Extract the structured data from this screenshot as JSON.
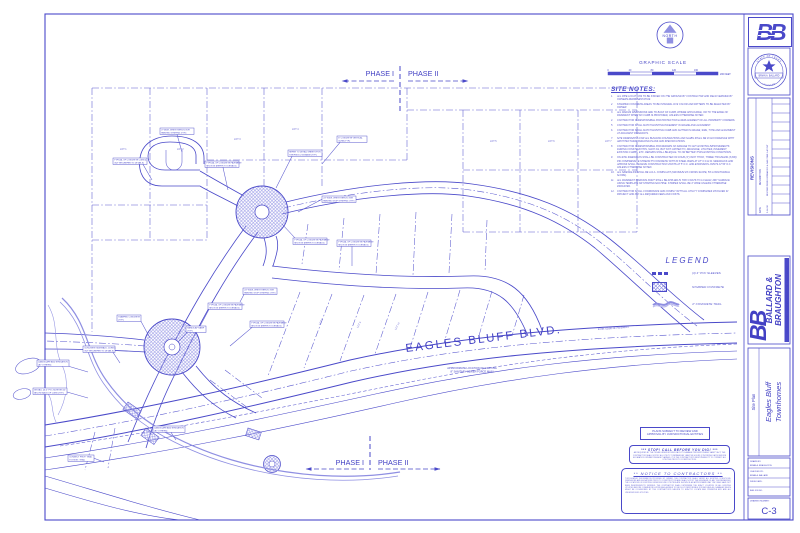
{
  "colors": {
    "line_blue": "#4a49c9",
    "light_blue": "#8f8fe2"
  },
  "north_arrow": {
    "label": "NORTH"
  },
  "graphic_scale": {
    "title": "GRAPHIC SCALE",
    "ticks": [
      "0",
      "40",
      "80",
      "120",
      "160"
    ],
    "end_label": "200 FEET"
  },
  "phases": {
    "top": {
      "left": "PHASE I",
      "right": "PHASE II"
    },
    "bottom": {
      "left": "PHASE I",
      "right": "PHASE II"
    }
  },
  "site_notes": {
    "title": "SITE NOTES:",
    "items": [
      "ALL PIPE LOCATIONS TO BE STAKED ON THE GROUND BY CONTRACTOR AND FIELD VERIFIED BY OWNERS REPRESENTATIVE.",
      "STAMPED CONCRETE AREAS TO BE INTEGRAL DYE COLOR AND PATTERN TO BE SELECTED BY OWNER.",
      "ALL RADIUS DIMENSIONS ARE TO BACK OF CURB, WHERE APPLICABLE, OR TO THE EDGE OF PAVEMENT WHEN NO CURB IS PROPOSED, UNLESS OTHERWISE NOTED.",
      "CONTRACTOR IS RESPONSIBLE FOR PROTECTION & REPLACEMENT OF ALL PROPERTY CORNERS.",
      "CONTRACTOR SHALL MATCH EXISTING PAVEMENT IN GRADE AND ALIGNMENT.",
      "CONTRACTOR SHALL MATCH EXISTING CURB AND GUTTER IN GRADE, SIZE, TYPE AND ALIGNMENT AT ADJACENT ROADWAYS.",
      "SITE DIMENSIONS FOR ALL BUILDING FOUNDATIONS AND SLABS SHALL BE IN ACCORDANCE WITH ARCHITECTURAL BUILDING PLANS AND SPECIFICATIONS.",
      "CONTRACTOR IS RESPONSIBLE FOR REPAIRS OF DAMAGE TO ANY EXISTING IMPROVEMENTS DURING CONSTRUCTION, SUCH AS, BUT NOT LIMITED TO, DRAINAGE, UTILITIES, PAVEMENT, EXISTING CURBS, ETC. REPAIRS SHALL BE EQUAL TO OR BETTER THAN EXISTING CONDITIONS.",
      "ON-SITE SIDEWALKS SHALL BE CONSTRUCTED OF FOUR (4\") INCH THICK, THREE THOUSAND (3,000) PSI COMPRESSIVE STRENGTH CONCRETE WITH #3 STEEL BARS AT 18\" O.C.E.W. SIDEWALKS AND APRONS SHALL RECEIVE CONSTRUCTION JOINTS AT 5' O.C. AND EXPANSION JOINTS AT 50' O.C. UNLESS OTHERWISE NOTED.",
      "ALL SIDEWALKS SHALL BE A.D.A. COMPLIANT (MAXIMUM 2% CROSS SLOPE, 5% LONGITUDINAL SLOPE).",
      "ALL PAVEMENT MARKING PAINT SHALL BE APPLIED IN TWO COATS TO A CLEAN, DRY SURFACE USING TEMPLATE OR STRIPING MACHINE. STRIPES SHALL BE 4\" WIDE UNLESS OTHERWISE INDICATED.",
      "CONTRACTOR SHALL COORDINATE AND COMPLY WITH ALL UTILITY COMPANIES INVOLVED IN PROJECT AND PAY ALL REQUIRED FEES AND COSTS."
    ]
  },
  "legend": {
    "title": "LEGEND",
    "items": [
      {
        "label": "(3) 4\" PVC SLEEVES"
      },
      {
        "label": "STAMPED CONCRETE"
      },
      {
        "label": "4\" CONCRETE TRAIL"
      }
    ]
  },
  "plan": {
    "road_label": "EAGLES BLUFF BLVD.",
    "force_main_note_1": "APPROXIMATE LOCATION OF EXISTING",
    "force_main_note_2": "8\" SANITARY SEWER FORCE MAIN",
    "exist_label": "EXIST. EDGE OF PAVEMENT",
    "lot_labels": [
      "LOT 1",
      "LOT 2",
      "LOT 3",
      "LOT 4",
      "LOT 5",
      "LOT 6",
      "LOT 7",
      "LOT 8",
      "LOT 9",
      "LOT 10"
    ],
    "callouts": [
      {
        "l1": "4\" WIDE, WHITE REFLECTIVE",
        "l2": "PAINTED STRIPING (TYP.)"
      },
      {
        "l1": "TYPICAL OF CONCRETE CURB &",
        "l2": "GUTTER (REFER TO DETAILS)"
      },
      {
        "l1": "TYPICAL OF CONCRETE PAVEMENT",
        "l2": "SECTION (REFER TO DETAILS)"
      },
      {
        "l1": "REFER TO DETAIL SHEETS FOR",
        "l2": "STRIPING & SIGNAGE (TYP.)"
      },
      {
        "l1": "6\" CONCRETE VERTICAL",
        "l2": "CURB (TYP.)"
      },
      {
        "l1": "24\" WIDE, WHITE REFLECTIVE",
        "l2": "PAINTED STOP STRIPING (TYP.)"
      },
      {
        "l1": "TYPICAL OF CONCRETE PAVEMENT",
        "l2": "SECTION (REFER TO DETAILS)"
      },
      {
        "l1": "TYPICAL OF CONCRETE PAVEMENT",
        "l2": "SECTION (REFER TO DETAILS)"
      },
      {
        "l1": "24\" WIDE, WHITE REFLECTIVE",
        "l2": "PAINTED STOP STRIPING (TYP.)"
      },
      {
        "l1": "TYPICAL OF CONCRETE PAVEMENT",
        "l2": "SECTION (REFER TO DETAILS)"
      },
      {
        "l1": "STAMPED CONCRETE",
        "l2": "(TYP.)"
      },
      {
        "l1": "TYPICAL OF CONCRETE PAVEMENT",
        "l2": "SECTION (REFER TO DETAILS)"
      },
      {
        "l1": "HANDICAP RAMP",
        "l2": "(TYP.)"
      },
      {
        "l1": "LANDSCAPE AND IRRIGATION",
        "l2": "(BY OTHERS)"
      },
      {
        "l1": "INSTALL (3) 4\" PVC SLEEVES 24\"",
        "l2": "BELOW BACK OF CURB (TYP.)"
      },
      {
        "l1": "CONCRETE SIDEWALK, CURB &",
        "l2": "GUTTER (REFER TO DETAILS)"
      },
      {
        "l1": "LANDSCAPE AND IRRIGATION",
        "l2": "(BY OTHERS)"
      },
      {
        "l1": "CONNECT PROP. TRAIL",
        "l2": "TO EXIST. TRAIL"
      }
    ]
  },
  "approval_box": {
    "line1": "PLANS SUBJECT TO REVIEW AND",
    "line2": "APPROVAL BY JURISDICTIONAL ENTITIES"
  },
  "call_box": {
    "title": "***   STOP!  CALL BEFORE YOU DIG!   ***",
    "body": "AS REQUIRED BY THE TEXAS UNDERGROUND FACILITY DAMAGE PREVENTION AND SAFETY ACT, THE CONTRACTOR SHALL NOTIFY ALL UTILITY COMPANIES AT LEAST 48 HOURS (2 WORKING DAYS) BEFORE EXCAVATION OPERATIONS ARE PLANNED. IT IS THE CONTRACTOR'S RESPONSIBILITY TO CONTACT ALL UTILITIES PRIOR TO CONSTRUCTION."
  },
  "notice_box": {
    "title": "**   NOTICE TO CONTRACTORS   **",
    "body": "TOPOGRAPHIC INFORMATION PROVIDED BY OWNER. THE CONTRACTOR SHALL VERIFY ALL EXISTING CONDITIONS, DIMENSIONS AND ELEVATIONS PRIOR TO CONSTRUCTION AND SHALL NOTIFY THE ENGINEER OF ANY DISCREPANCIES. THE LOCATIONS OF EXISTING UNDERGROUND UTILITIES ARE SHOWN IN AN APPROXIMATE WAY ONLY AND HAVE NOT BEEN INDEPENDENTLY VERIFIED. THE CONTRACTOR SHALL DETERMINE THE EXACT LOCATION OF ALL EXISTING UTILITIES BEFORE COMMENCING WORK AND AGREES TO BE FULLY RESPONSIBLE FOR ANY AND ALL DAMAGES WHICH MIGHT BE OCCASIONED BY THE CONTRACTOR'S FAILURE TO EXACTLY LOCATE AND PRESERVE ANY AND ALL UNDERGROUND UTILITIES."
  },
  "title_block": {
    "bb_logo": "BB",
    "seal": {
      "top": "STATE OF TEXAS",
      "name": "BRIAN A. BALLARD",
      "bottom": "LICENSED"
    },
    "revisions": {
      "title": "REVISIONS",
      "col_date": "DATE",
      "col_desc": "DESCRIPTION",
      "rows": [
        {
          "date": "5-14-08",
          "desc": "REVISED DRIVE ENTRANCES & SAN. SWR. LAYOUT"
        }
      ]
    },
    "firm": {
      "logo": "BB",
      "name_line1": "BALLARD &",
      "name_line2": "BRAUGHTON",
      "tagline": "CIVIL ENGINEERING - LANDSCAPE ARCHITECTURE - LAND PLANNING"
    },
    "project": {
      "sheet_title": "Site Plan",
      "name_line1": "Eagles Bluff",
      "name_line2": "Townhomes"
    },
    "fields": [
      {
        "label": "DRAWN BY:",
        "value": "BRIAN A. BRAUGHTON"
      },
      {
        "label": "CHECKED BY:",
        "value": "BRIAN A. BALLARD"
      },
      {
        "label": "ISSUE DATE:",
        "value": ""
      },
      {
        "label": "B&B JOB NO:",
        "value": ""
      }
    ],
    "drawing_number_label": "DRAWING NUMBER:",
    "drawing_number": "C-3"
  }
}
